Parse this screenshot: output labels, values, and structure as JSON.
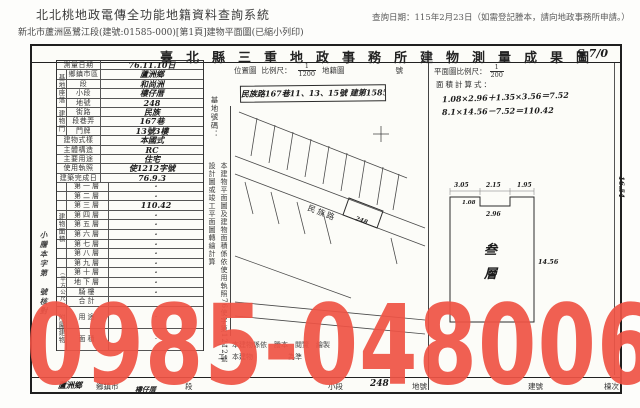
{
  "header": {
    "system_title": "北北桃地政電傳全功能地籍資料查詢系統",
    "query_date": "查詢日期：115年2月23日（如需登記謄本，請向地政事務所申請。）",
    "doc_line": "新北市蘆洲區鷺江段(建號:01585-000)[第1頁]建物平面圖(已縮小列印)"
  },
  "watermark": {
    "text": "0985-048006",
    "color": "#ef5345"
  },
  "form": {
    "title": "臺北縣三重地政事務所建物測量成果圖",
    "page_mark": "S 7/0",
    "stamp_note": "小謄本字第　號核對",
    "site_group_label": "基地座落",
    "door_group_label": "建物門牌",
    "floor_group_label": "建物面積",
    "floor_unit_label": "(平方公尺)",
    "annex_group_label": "附屬建物",
    "fields": [
      {
        "label": "測量日期",
        "value": "76.11.10日"
      },
      {
        "label": "鄉鎮市區",
        "value": "蘆洲鄉"
      },
      {
        "label": "段",
        "value": "和尚洲"
      },
      {
        "label": "小段",
        "value": "樓仔厝"
      },
      {
        "label": "地號",
        "value": "248"
      },
      {
        "label": "街路",
        "value": "民族"
      },
      {
        "label": "段巷弄",
        "value": "167巷"
      },
      {
        "label": "門牌",
        "value": "13號3樓"
      },
      {
        "label": "建物式樣",
        "value": "本國式"
      },
      {
        "label": "主體構造",
        "value": "RC"
      },
      {
        "label": "主要用途",
        "value": "住宅"
      },
      {
        "label": "使用執照",
        "value": "使1212字號"
      },
      {
        "label": "建築完成日期",
        "value": "76.9.3"
      }
    ],
    "floors": [
      {
        "label": "第一層",
        "value": "·"
      },
      {
        "label": "第二層",
        "value": "·"
      },
      {
        "label": "第三層",
        "value": "110.42"
      },
      {
        "label": "第四層",
        "value": "·"
      },
      {
        "label": "第五層",
        "value": "·"
      },
      {
        "label": "第六層",
        "value": "·"
      },
      {
        "label": "第七層",
        "value": "·"
      },
      {
        "label": "第八層",
        "value": "·"
      },
      {
        "label": "第九層",
        "value": "·"
      },
      {
        "label": "第十層",
        "value": "·"
      },
      {
        "label": "地下層",
        "value": "·"
      },
      {
        "label": "騎樓",
        "value": "·"
      },
      {
        "label": "合計",
        "value": ""
      }
    ],
    "annex_rows": [
      {
        "label": "用途",
        "value": "·"
      },
      {
        "label": "面積",
        "value": "·"
      }
    ],
    "vertical_notes": {
      "site_no": "基地號碼：",
      "transcription": "本建物平面圖及建物面積係依使用執照76使字第1212號設計圖或竣工平面圖轉繪計算"
    },
    "map": {
      "loc_label": "位置圖",
      "scale_label": "比例尺：",
      "scale_num": "1",
      "scale_den": "1200",
      "sheet_label": "地籍圖",
      "no_label": "號",
      "annotation": "民族路167巷11、13、15號 建第1585",
      "road_label": "民族路",
      "lot_text": "248"
    },
    "plan": {
      "scale_label": "平面圖比例尺：",
      "scale_num": "1",
      "scale_den": "200",
      "calc_label": "面積計算式：",
      "calc_line1": "1.08×2.96＋1.35×3.56＝7.52",
      "calc_line2": "8.1×14.56－7.52＝110.42",
      "floor_char1": "叁",
      "floor_char2": "層",
      "dim_top_left": "3.05",
      "dim_top_mid": "2.15",
      "dim_top_right": "1.95",
      "dim_notch_h": "1.08",
      "dim_notch_w": "2.96",
      "dim_right": "14.56",
      "margin_note": "16.54"
    },
    "bottom_notes": [
      "一、本建物係依　謄本　閱覽　繪製",
      "二、本建物　　　　　為準"
    ],
    "bottom_strip": {
      "township_hand": "蘆洲鄉",
      "township_label": "鄉鎮市",
      "section_hand": "樓仔厝",
      "section_label": "段",
      "subsection_label": "小段",
      "lot_value": "248",
      "lot_label": "地號",
      "building_no_label": "建號",
      "unit_label": "棟次"
    }
  }
}
